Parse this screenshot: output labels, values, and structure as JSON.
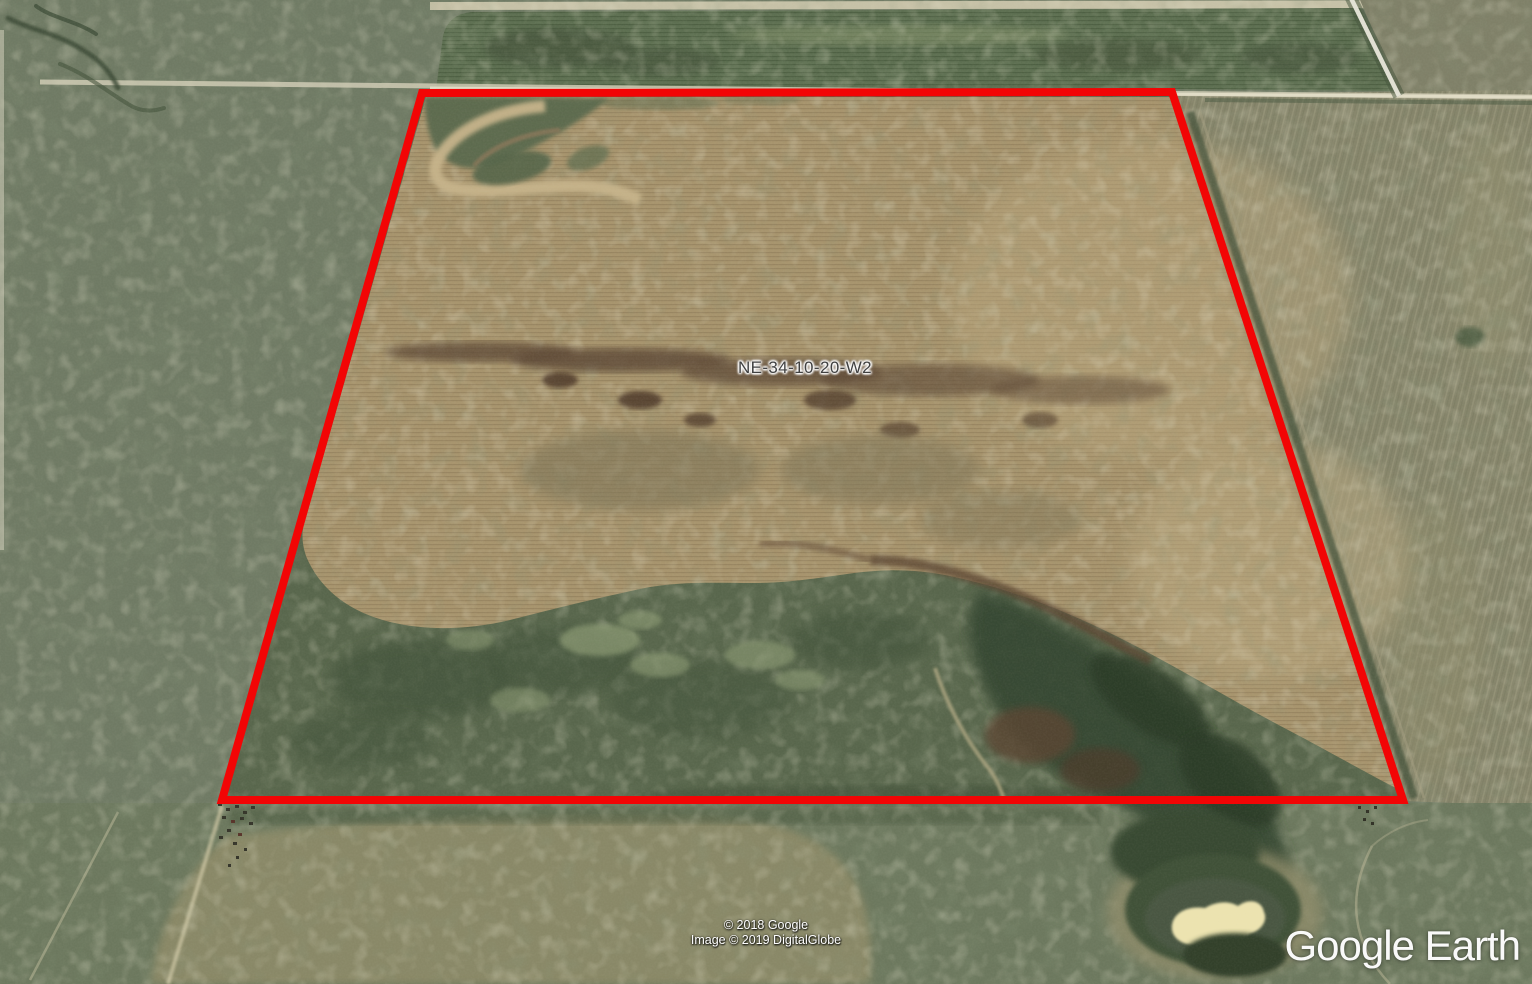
{
  "app": {
    "name": "Google Earth"
  },
  "map_overlay": {
    "parcel_label": "NE-34-10-20-W2",
    "boundary_color": "#f20505",
    "boundary_stroke_width": "8",
    "boundary_points": "422,93 1172,92 1403,800 222,800"
  },
  "attribution": {
    "copyright_line1": "© 2018 Google",
    "copyright_line2": "Image © 2019 DigitalGlobe"
  },
  "watermark": {
    "text": "Google Earth"
  },
  "scene": {
    "description": "Satellite aerial view of a farmland quarter section outlined in red; brown cultivated field, green pasture with slough and pond, surrounded by grassland and section roads",
    "colors": {
      "grassland": "#6f7a64",
      "cultivated_field": "#a7946d",
      "pasture": "#58664c",
      "crop_field_north": "#5d6f51",
      "wetland": "#344630",
      "pond_sandbar": "#ece3b0",
      "road": "#d5d0b9"
    }
  }
}
